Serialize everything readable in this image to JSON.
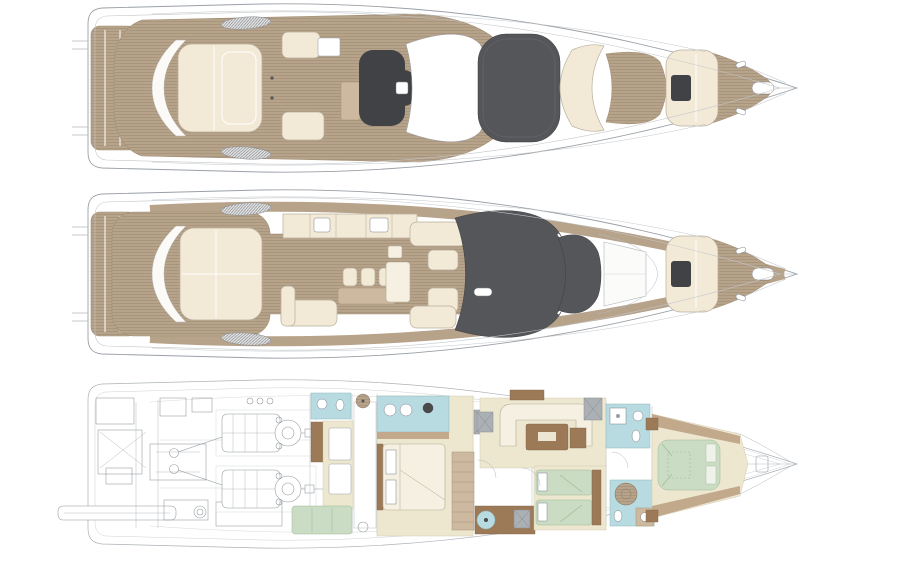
{
  "figure": {
    "type": "diagram",
    "subject": "motor-yacht-deck-plans",
    "background": "#ffffff",
    "views": [
      {
        "label": "flybridge-deck",
        "elements": [
          "stern-platform",
          "teak-deck",
          "aft-sunpad",
          "lounge-seating",
          "wet-bar-cabinet",
          "helm-station",
          "hardtop",
          "sunroof",
          "bow-lounge-seat",
          "bow-teak-sunpad",
          "bow-sunpad",
          "foredeck-windlass",
          "air-vents"
        ]
      },
      {
        "label": "main-deck",
        "elements": [
          "stern-platform",
          "side-decks",
          "cockpit-teak-floor",
          "transom-seat",
          "aft-sunpad",
          "galley-units",
          "bar-stools",
          "bar-counter",
          "cockpit-sofa",
          "salon-settee",
          "helm-seats",
          "salon-table",
          "windshield",
          "tinted-foredeck-glass",
          "coachroof-panels",
          "bow-sunpad",
          "foredeck-windlass",
          "air-vents"
        ]
      },
      {
        "label": "lower-deck",
        "elements": [
          "passerelle",
          "swim-platform-machinery",
          "propellers",
          "engine-room",
          "twin-engines",
          "crew-bathroom",
          "crew-cabin",
          "crew-settee",
          "tank-void",
          "master-bathroom",
          "master-cabin",
          "master-bed",
          "staircase",
          "galley",
          "dinette-sofa",
          "dinette-table",
          "twin-cabin",
          "twin-beds",
          "day-head",
          "ensuite-bathroom",
          "round-shower",
          "vip-cabin",
          "vip-bed",
          "bow-locker"
        ]
      }
    ]
  },
  "colors": {
    "teak": "#b7a28a",
    "teakline": "#a28f77",
    "cream": "#f2e9d7",
    "cream2": "#f5f0e1",
    "floor": "#ede7cf",
    "dark1": "#55565a",
    "dark2": "#414246",
    "blue": "#b7dbe0",
    "green": "#cbdcc4",
    "brown": "#9c7a58",
    "tanlight": "#cdb99f",
    "tanband": "#c3a98b",
    "linegray": "#9aa0a6",
    "linelight": "#c2c7cb",
    "white": "#ffffff"
  }
}
